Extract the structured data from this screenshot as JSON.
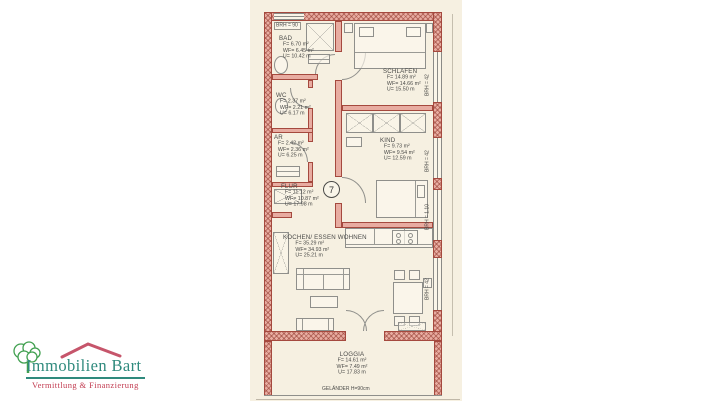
{
  "logo": {
    "name": "Immobilien Bart",
    "tagline": "Vermittlung & Finanzierung",
    "colors": {
      "name_teal": "#2f8a7d",
      "tagline_red": "#c23b50",
      "roof_red": "#c6556b",
      "tree_green": "#41a050"
    }
  },
  "plan": {
    "unit_number": "7",
    "railing_label": "GELÄNDER H=90cm",
    "window_labels": {
      "bath_top": "BRH = 90",
      "schlafen": "BRH = 42",
      "kind": "BRH = 42",
      "flur": "BRH = 1.10",
      "wohnen": "BRH = 42"
    },
    "rooms": [
      {
        "name": "BAD",
        "f": "F= 6.70 m²",
        "wf": "WF= 6.45 m²",
        "u": "U= 10.42 m"
      },
      {
        "name": "SCHLAFEN",
        "f": "F= 14.89 m²",
        "wf": "WF= 14.66 m²",
        "u": "U= 15.50 m"
      },
      {
        "name": "WC",
        "f": "F= 2.37 m²",
        "wf": "WF= 2.21 m²",
        "u": "U= 6.17 m"
      },
      {
        "name": "AR",
        "f": "F= 2.42 m²",
        "wf": "WF= 2.36 m²",
        "u": "U= 6.25 m"
      },
      {
        "name": "KIND",
        "f": "F= 9.73 m²",
        "wf": "WF= 9.54 m²",
        "u": "U= 12.59 m"
      },
      {
        "name": "FLUR",
        "f": "F= 11.12 m²",
        "wf": "WF= 10.87 m²",
        "u": "U= 17.98 m"
      },
      {
        "name": "KOCHEN/ ESSEN WOHNEN",
        "f": "F= 35.29 m²",
        "wf": "WF= 34.93 m²",
        "u": "U= 25.21 m"
      },
      {
        "name": "LOGGIA",
        "f": "F= 14.61 m²",
        "wf": "WF= 7.49 m²",
        "u": "U= 17.83 m"
      }
    ],
    "colors": {
      "paper": "#f6f0e1",
      "wall_fill": "#e8aca1",
      "wall_line": "#a5493e",
      "drawing_line": "#8f8f8b",
      "text": "#4a4a48"
    }
  }
}
